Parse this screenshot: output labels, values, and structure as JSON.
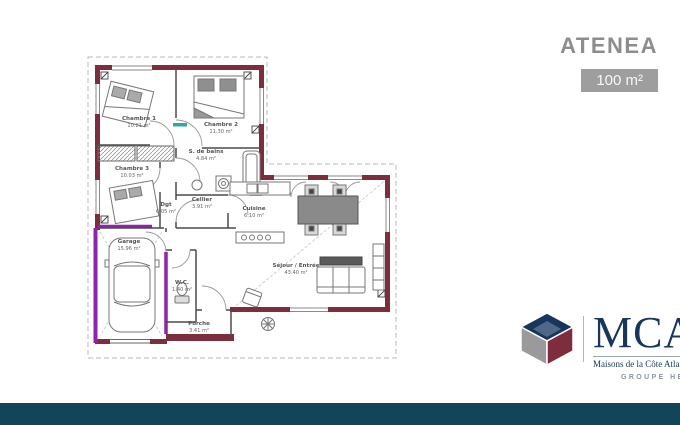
{
  "header": {
    "model_name": "ATENEA",
    "surface": "100 m²"
  },
  "plan": {
    "rooms": [
      {
        "name": "Chambre 1",
        "area": "10.21 m²"
      },
      {
        "name": "Chambre 2",
        "area": "11.30 m²"
      },
      {
        "name": "Chambre 3",
        "area": "10.03 m²"
      },
      {
        "name": "S. de bains",
        "area": "4.84 m²"
      },
      {
        "name": "Dgt",
        "area": "6.05 m²"
      },
      {
        "name": "Cellier",
        "area": "3.91 m²"
      },
      {
        "name": "Cuisine",
        "area": "6.10 m²"
      },
      {
        "name": "Séjour / Entrée",
        "area": "43.40 m²"
      },
      {
        "name": "W.C.",
        "area": "1.40 m²"
      },
      {
        "name": "Garage",
        "area": "15.96 m²"
      },
      {
        "name": "Porche",
        "area": "3.41 m²"
      }
    ]
  },
  "branding": {
    "logo_text": "MCA",
    "logo_subtitle": "Maisons de la Côte Atlantique",
    "group_label": "GROUPE HEXAŌM"
  },
  "colors": {
    "exterior_wall": "#7e2d3e",
    "accent_purple": "#8e24aa",
    "threshold_teal": "#2fa8a2",
    "footer_bar": "#12455a",
    "title_grey": "#8d8d8d",
    "surface_badge_grey": "#9e9e9e",
    "logo_navy": "#16365c"
  }
}
